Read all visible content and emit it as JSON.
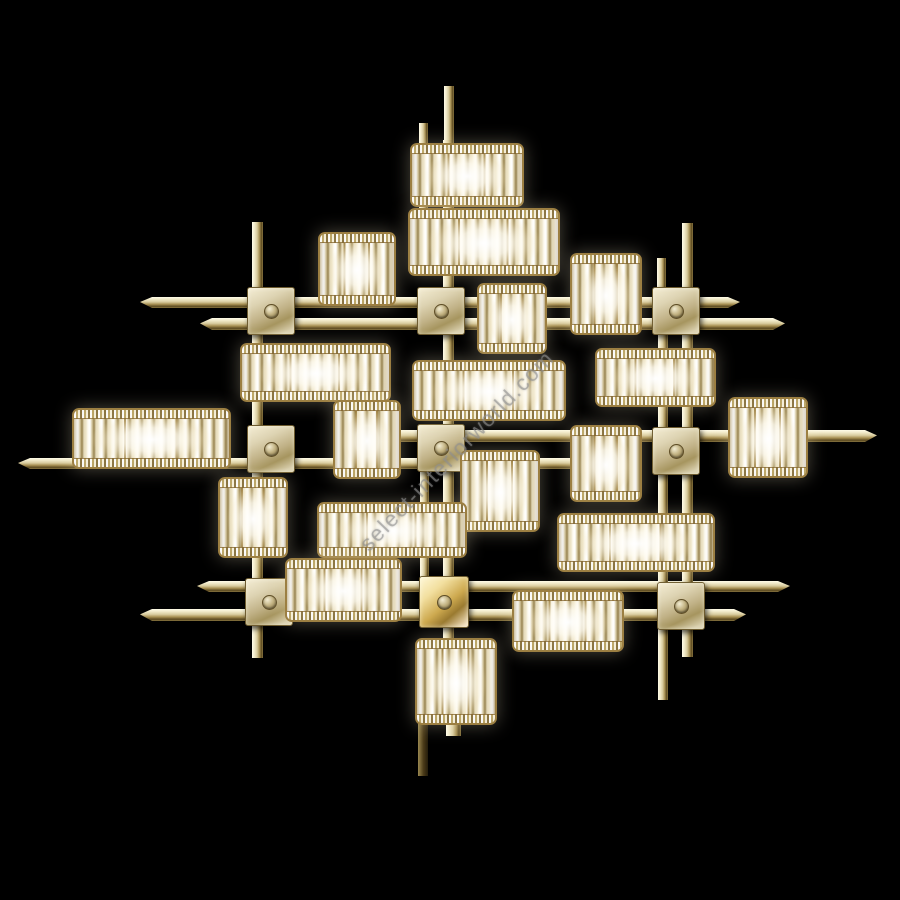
{
  "scene": {
    "description": "Gold-plated modernist wall lamp: orthogonal grid of brass rods and square mounting plates carrying rectangular crystal-prism shades with lit bulbs, photographed on a black background",
    "background_color": "#000000",
    "colors": {
      "brass_highlight": "#fffce9",
      "brass_mid": "#d9cc9f",
      "brass_shadow": "#5c4a20",
      "plate_face": "#ddd3b2",
      "shade_frame_gold": "#9c7f42",
      "crystal_white": "#ffffff",
      "glow_warm": "#fff3cd"
    },
    "watermark": {
      "text": "select-interiorworld.com",
      "color": "rgba(145,145,145,0.58)",
      "rotation_deg": -46,
      "center_x": 452,
      "center_y": 452
    },
    "rods_horizontal": [
      {
        "x": 140,
        "y": 297,
        "w": 600,
        "h": 11,
        "taper": "lr"
      },
      {
        "x": 200,
        "y": 318,
        "w": 585,
        "h": 12,
        "taper": "lr"
      },
      {
        "x": 18,
        "y": 458,
        "w": 585,
        "h": 11,
        "taper": "l"
      },
      {
        "x": 380,
        "y": 430,
        "w": 497,
        "h": 12,
        "taper": "r"
      },
      {
        "x": 197,
        "y": 581,
        "w": 593,
        "h": 11,
        "taper": "lr"
      },
      {
        "x": 140,
        "y": 609,
        "w": 606,
        "h": 12,
        "taper": "lr"
      }
    ],
    "rods_vertical": [
      {
        "x": 444,
        "y": 86,
        "w": 10,
        "h": 60,
        "dark": false
      },
      {
        "x": 443,
        "y": 140,
        "w": 11,
        "h": 518,
        "dark": false
      },
      {
        "x": 419,
        "y": 123,
        "w": 9,
        "h": 102,
        "dark": false
      },
      {
        "x": 420,
        "y": 468,
        "w": 9,
        "h": 110,
        "dark": false
      },
      {
        "x": 252,
        "y": 222,
        "w": 11,
        "h": 436,
        "dark": false
      },
      {
        "x": 682,
        "y": 223,
        "w": 11,
        "h": 434,
        "dark": false
      },
      {
        "x": 657,
        "y": 258,
        "w": 9,
        "h": 32,
        "dark": false
      },
      {
        "x": 658,
        "y": 333,
        "w": 10,
        "h": 367,
        "dark": false
      },
      {
        "x": 446,
        "y": 716,
        "w": 15,
        "h": 20,
        "dark": false
      },
      {
        "x": 418,
        "y": 718,
        "w": 10,
        "h": 58,
        "dark": true
      }
    ],
    "plates": [
      {
        "x": 247,
        "y": 287,
        "w": 46,
        "h": 46,
        "bright": false
      },
      {
        "x": 417,
        "y": 287,
        "w": 46,
        "h": 46,
        "bright": false
      },
      {
        "x": 652,
        "y": 287,
        "w": 46,
        "h": 46,
        "bright": false
      },
      {
        "x": 247,
        "y": 425,
        "w": 46,
        "h": 46,
        "bright": false
      },
      {
        "x": 417,
        "y": 424,
        "w": 46,
        "h": 46,
        "bright": false
      },
      {
        "x": 652,
        "y": 427,
        "w": 46,
        "h": 46,
        "bright": false
      },
      {
        "x": 245,
        "y": 578,
        "w": 46,
        "h": 46,
        "bright": false
      },
      {
        "x": 419,
        "y": 576,
        "w": 48,
        "h": 50,
        "bright": true
      },
      {
        "x": 657,
        "y": 582,
        "w": 46,
        "h": 46,
        "bright": false
      }
    ],
    "shades": [
      {
        "x": 410,
        "y": 143,
        "w": 110,
        "h": 60
      },
      {
        "x": 408,
        "y": 208,
        "w": 148,
        "h": 64
      },
      {
        "x": 318,
        "y": 232,
        "w": 74,
        "h": 70
      },
      {
        "x": 570,
        "y": 253,
        "w": 68,
        "h": 78
      },
      {
        "x": 477,
        "y": 283,
        "w": 66,
        "h": 67
      },
      {
        "x": 240,
        "y": 343,
        "w": 147,
        "h": 55
      },
      {
        "x": 412,
        "y": 360,
        "w": 150,
        "h": 57
      },
      {
        "x": 595,
        "y": 348,
        "w": 117,
        "h": 55
      },
      {
        "x": 72,
        "y": 408,
        "w": 155,
        "h": 57
      },
      {
        "x": 333,
        "y": 400,
        "w": 64,
        "h": 75
      },
      {
        "x": 218,
        "y": 477,
        "w": 66,
        "h": 77
      },
      {
        "x": 460,
        "y": 450,
        "w": 76,
        "h": 78
      },
      {
        "x": 570,
        "y": 425,
        "w": 68,
        "h": 73
      },
      {
        "x": 728,
        "y": 397,
        "w": 76,
        "h": 77
      },
      {
        "x": 557,
        "y": 513,
        "w": 154,
        "h": 55
      },
      {
        "x": 317,
        "y": 502,
        "w": 146,
        "h": 52
      },
      {
        "x": 512,
        "y": 590,
        "w": 108,
        "h": 58
      },
      {
        "x": 285,
        "y": 558,
        "w": 113,
        "h": 60
      },
      {
        "x": 415,
        "y": 638,
        "w": 78,
        "h": 83
      }
    ]
  }
}
